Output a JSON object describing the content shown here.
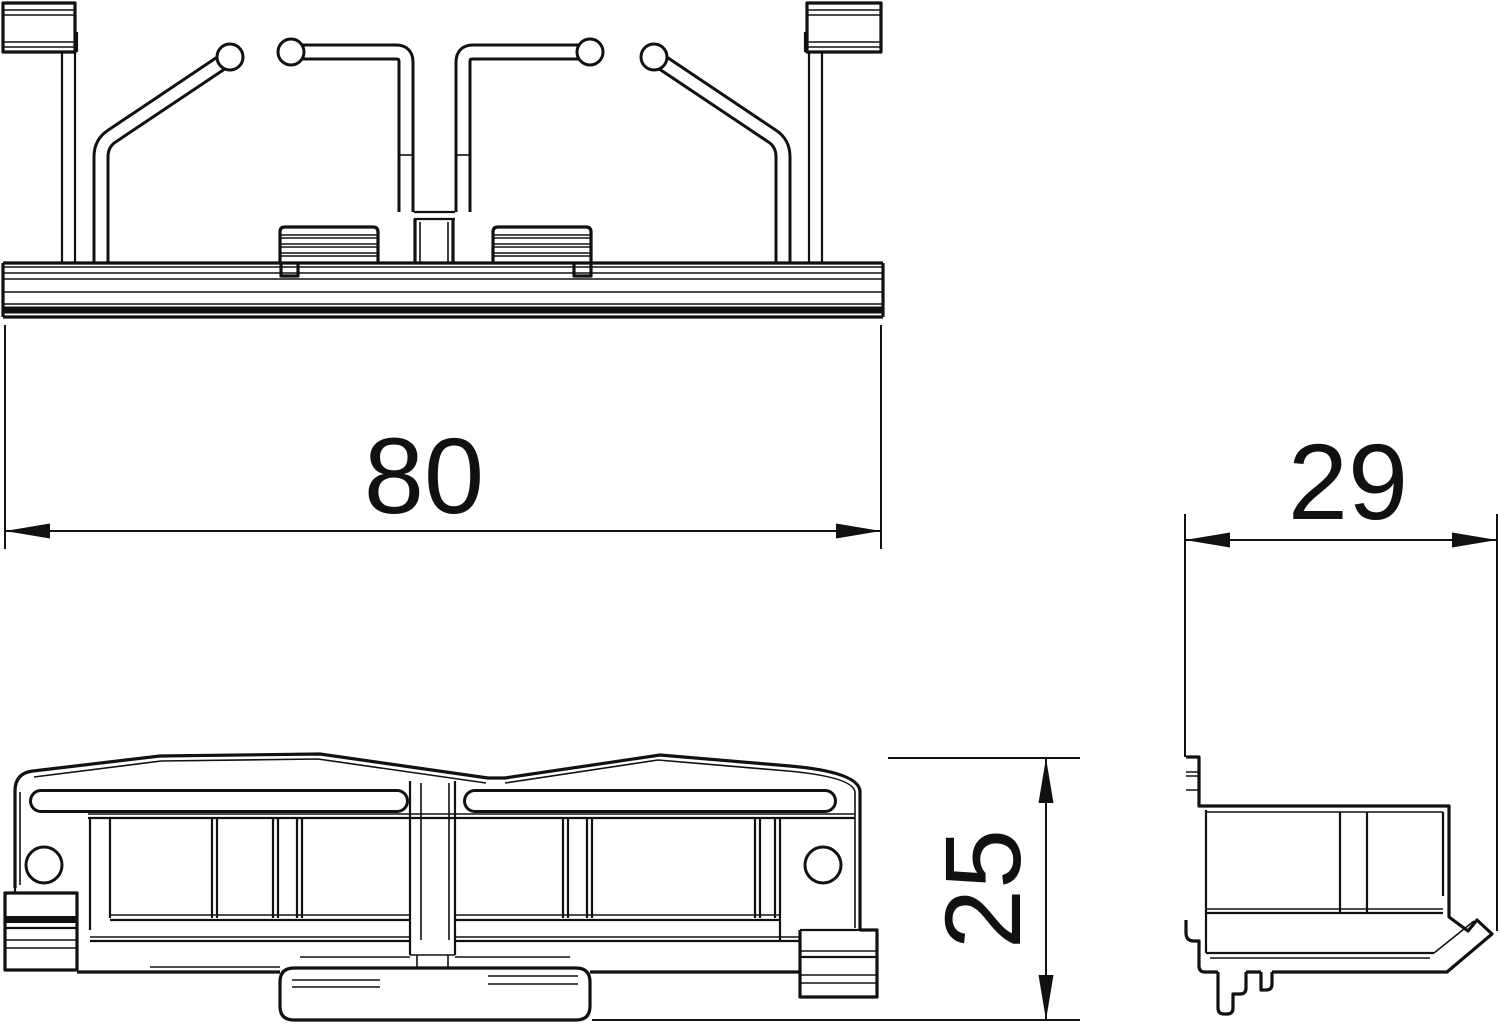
{
  "page": {
    "background_color": "#ffffff",
    "line_color": "#111111"
  },
  "drawing": {
    "type": "technical-orthographic-drawing",
    "dimensions": {
      "width": {
        "value": "80",
        "orientation": "horizontal"
      },
      "depth": {
        "value": "29",
        "orientation": "horizontal"
      },
      "height": {
        "value": "25",
        "orientation": "vertical"
      }
    }
  }
}
